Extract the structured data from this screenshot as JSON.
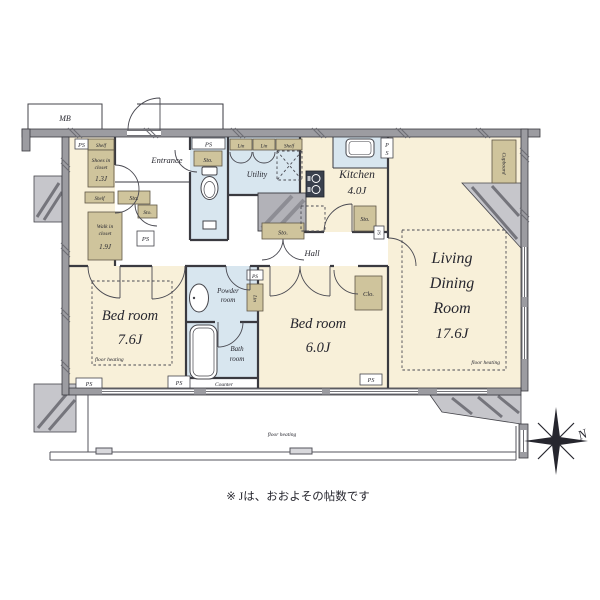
{
  "labels": {
    "mb": "MB",
    "ps": "PS",
    "ps_letters": [
      "P",
      "S"
    ],
    "sto": "Sto.",
    "shelf": "Shelf",
    "lin": "Lin",
    "clo": "Clo.",
    "cupboard": "Cupboard",
    "counter": "Counter",
    "floor_heating": "floor heating",
    "hall": "Hall",
    "entrance": "Entrance",
    "utility": "Utility"
  },
  "rooms": {
    "kitchen": {
      "name": "Kitchen",
      "size": "4.0J"
    },
    "living": {
      "lines": [
        "Living",
        "Dining",
        "Room"
      ],
      "size": "17.6J"
    },
    "bedroom1": {
      "name": "Bed room",
      "size": "7.6J"
    },
    "bedroom2": {
      "name": "Bed room",
      "size": "6.0J"
    },
    "powder": {
      "lines": [
        "Powder",
        "room"
      ]
    },
    "bath": {
      "lines": [
        "Bath",
        "room"
      ]
    },
    "shoes_closet": {
      "lines": [
        "Shoes in",
        "closet"
      ],
      "size": "1.3J"
    },
    "walkin_closet": {
      "lines": [
        "Walk in",
        "closet"
      ],
      "size": "1.9J"
    }
  },
  "compass": {
    "north": "N"
  },
  "footnote": "※ Jは、おおよその帖数です",
  "colors": {
    "floor_dry": "#f8f0d9",
    "floor_wet": "#d8e6ef",
    "cabinet": "#cfc49c",
    "wall": "#9c9ca1",
    "hatch_block": "#c6c6cb"
  }
}
